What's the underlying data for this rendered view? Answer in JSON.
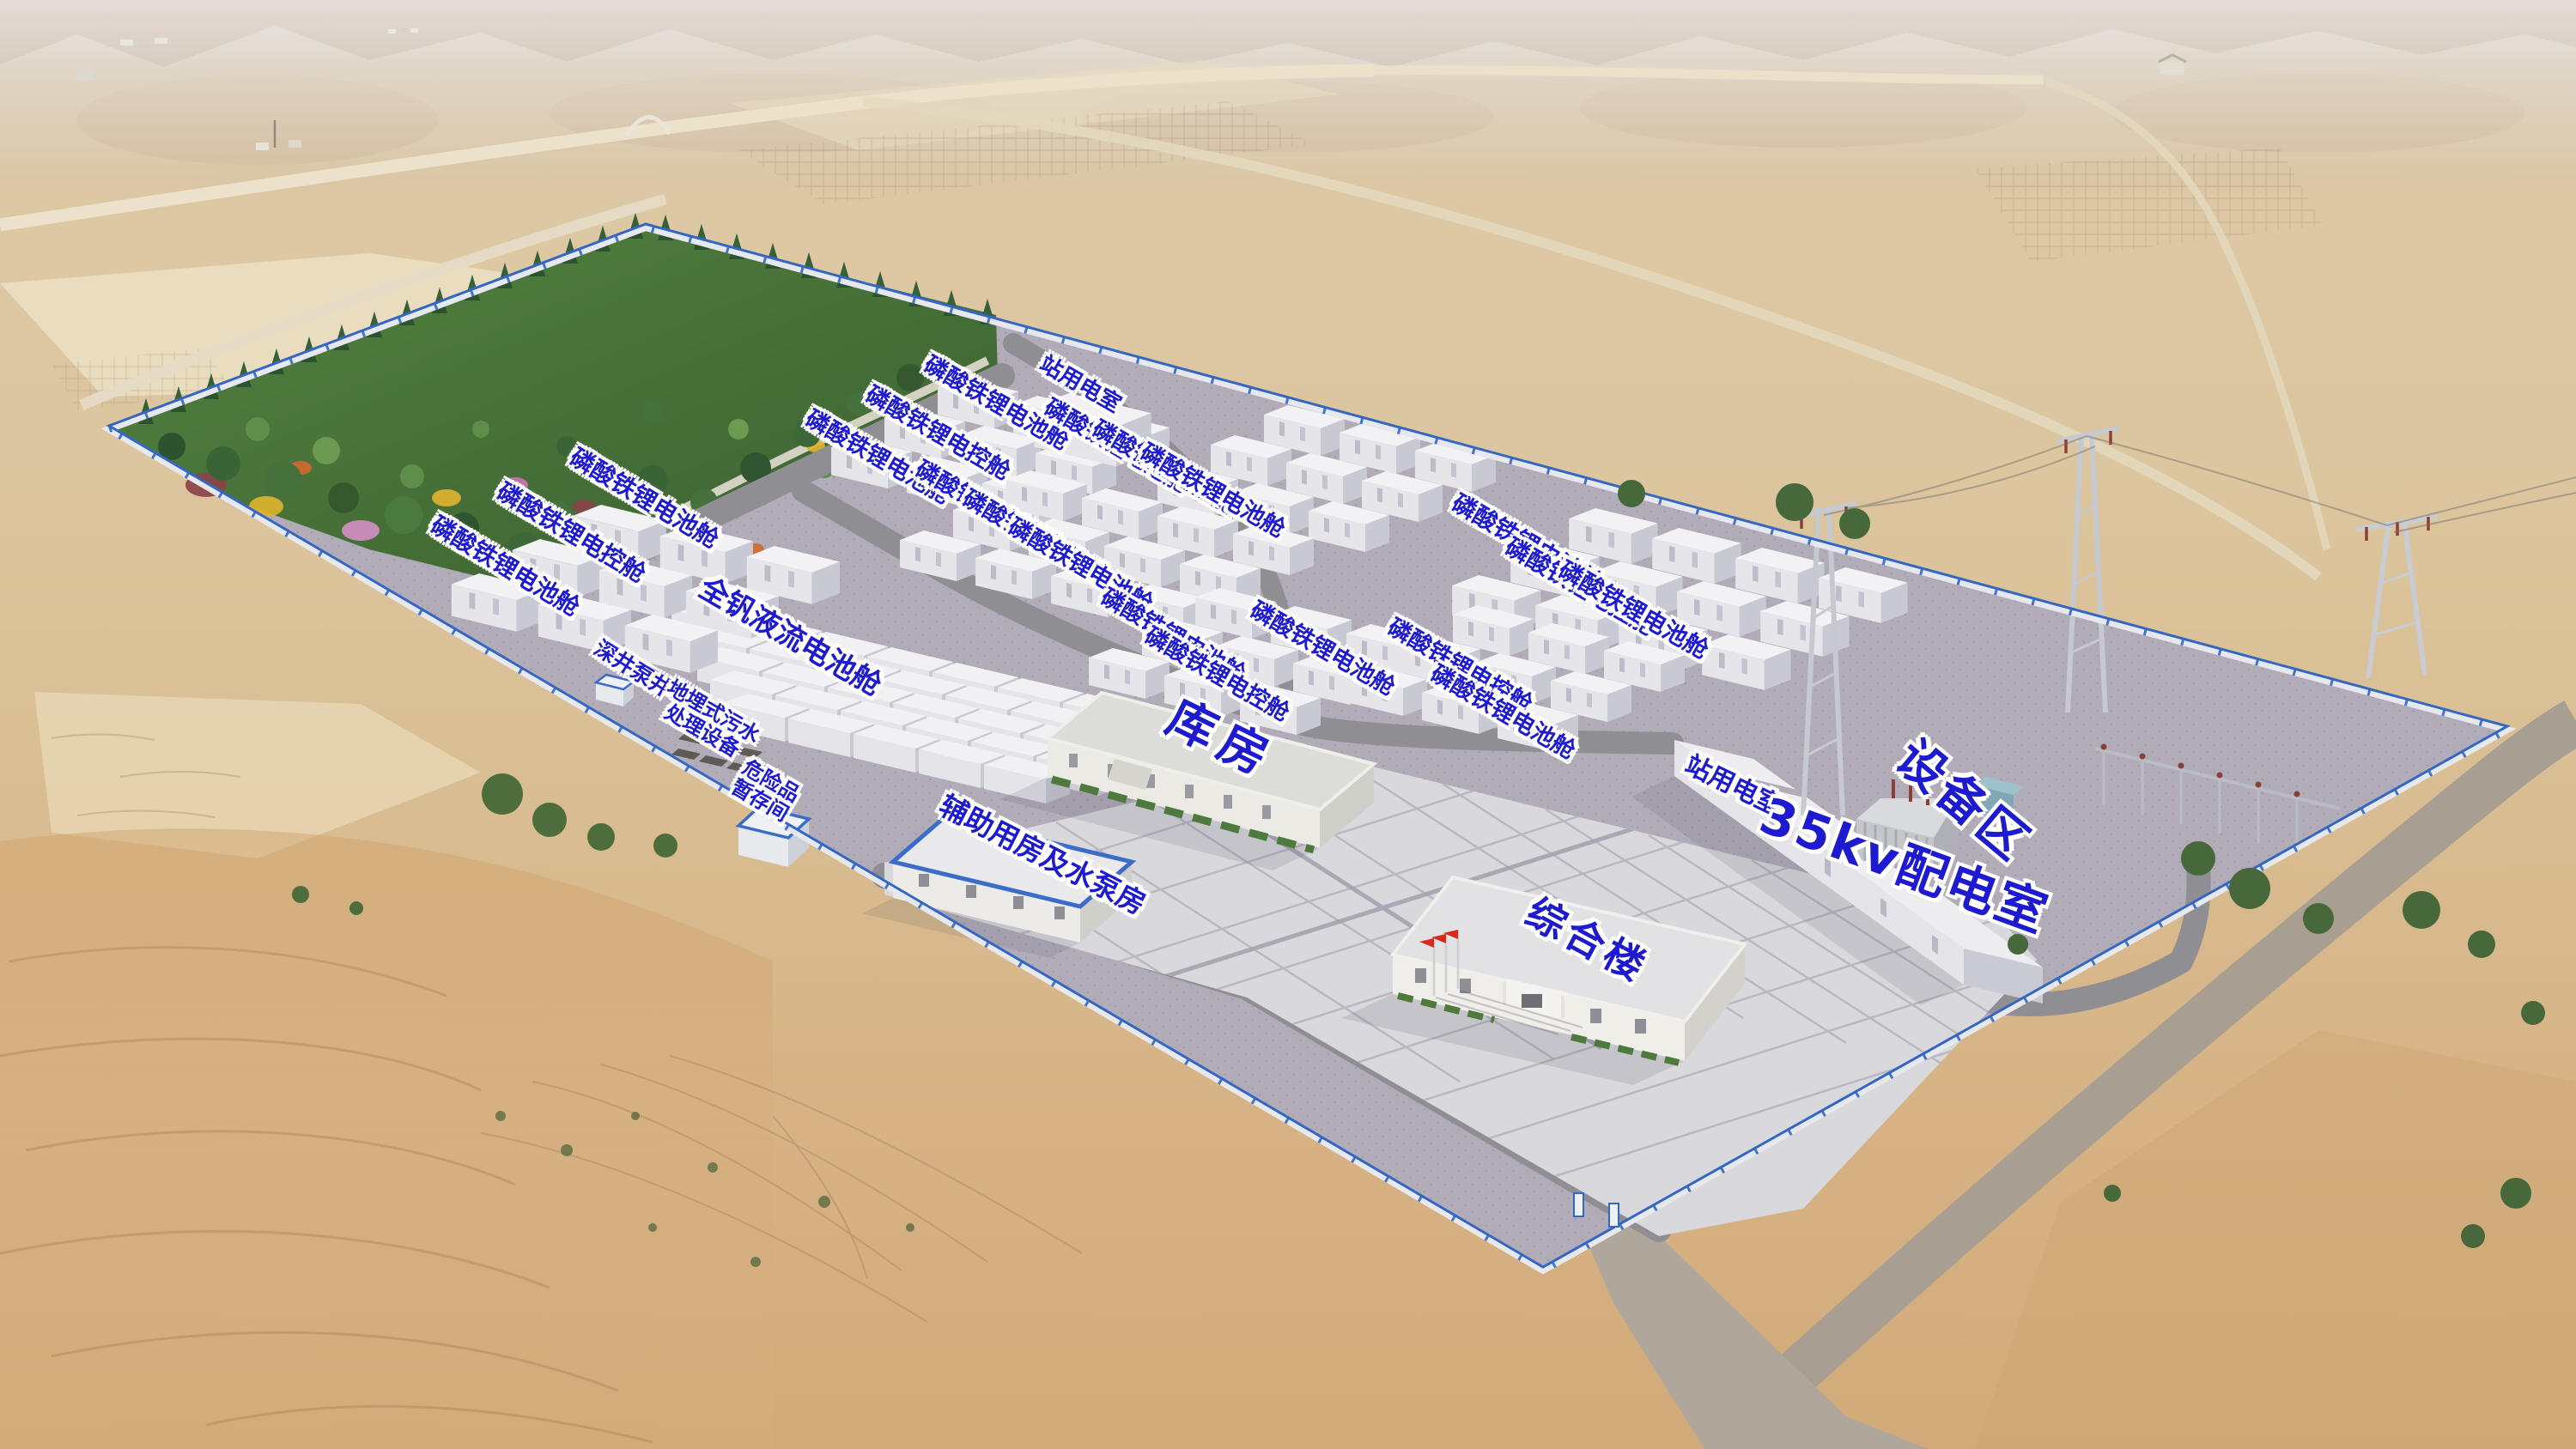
{
  "labels": {
    "lfp_battery_cabin": "磷酸铁锂电池舱",
    "lfp_control_cabin": "磷酸铁锂电控舱",
    "station_power_room": "站用电室",
    "vanadium_flow_battery_cabin": "全钒液流电池舱",
    "deep_well_pump": "深井泵井",
    "buried_sewage_treatment": "地埋式污水\n处理设备",
    "hazmat_storage": "危险品\n暂存间",
    "auxiliary_pump_house": "辅助用房及水泵房",
    "warehouse": "库房",
    "complex_building": "综合楼",
    "kv35_distribution_room": "35kv配电室",
    "equipment_area": "设备区"
  },
  "colors": {
    "label_text": "#1d1ad0",
    "label_outline": "#ffffff",
    "fence_trim": "#3467c3",
    "flag_red": "#d42b1f",
    "site_gravel": "#b1acb8",
    "road_gray": "#8e8e93",
    "plaza_tile": "#d9d8dc",
    "container_white": "#f2f2f5",
    "garden_green": "#4c763c",
    "desert_sand": "#d9bd92"
  }
}
